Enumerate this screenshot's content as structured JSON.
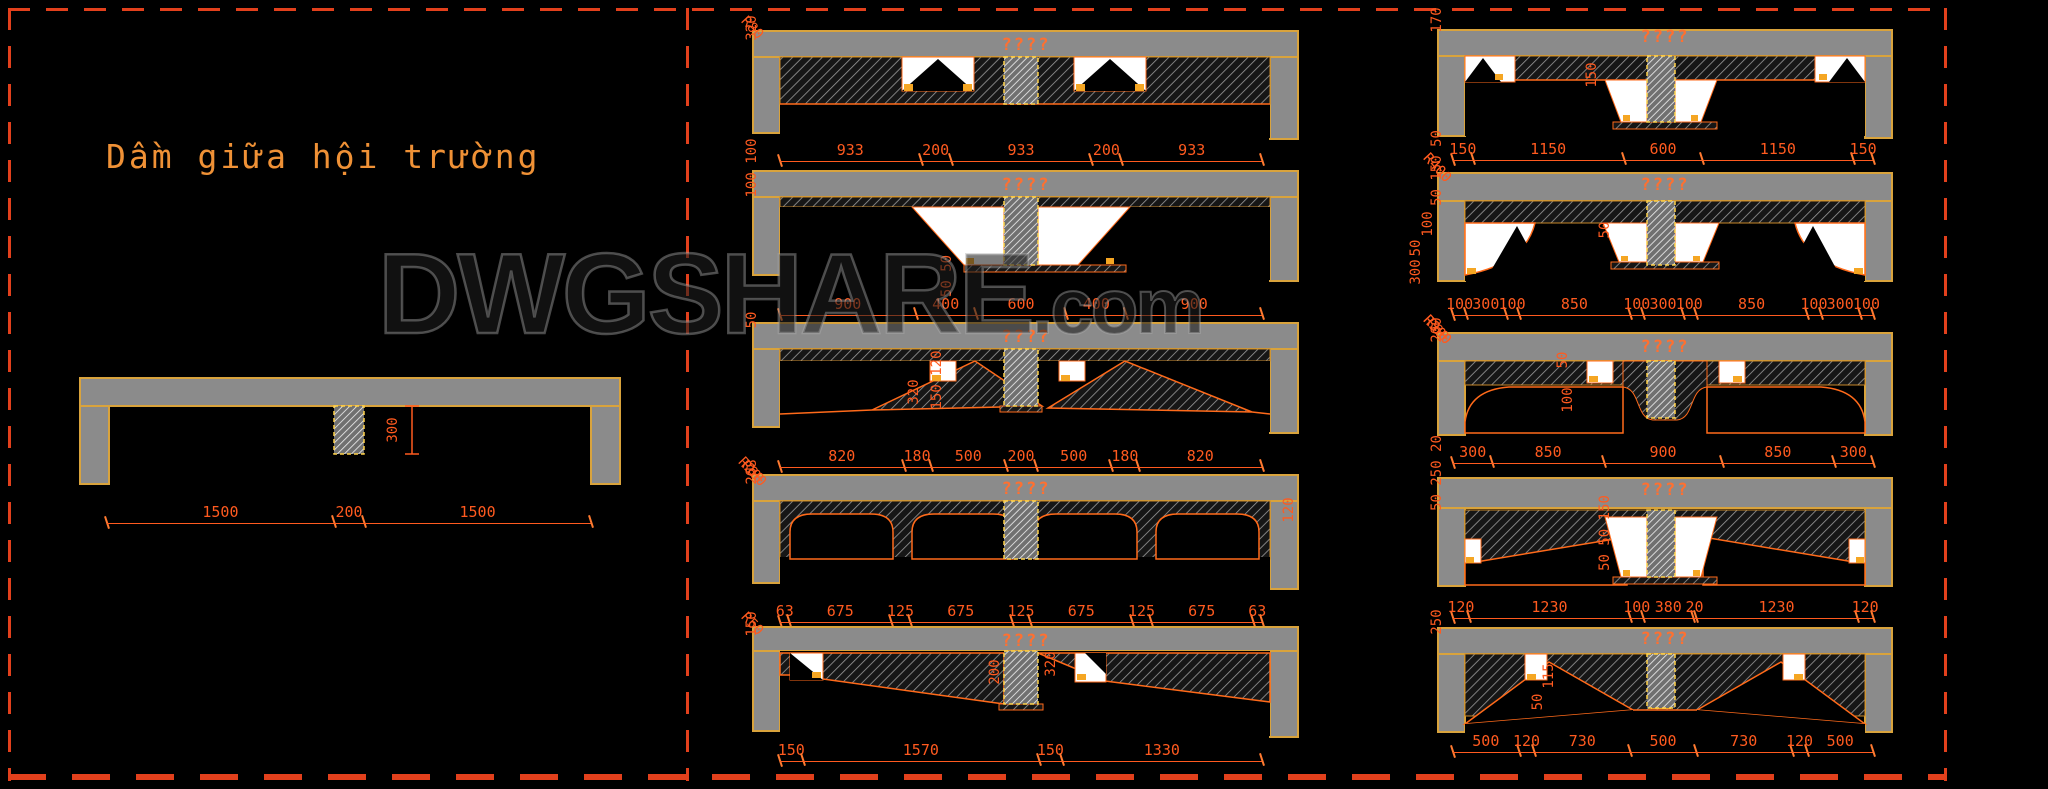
{
  "watermark": {
    "text": "DWGSHARE",
    "suffix": ".com"
  },
  "colors": {
    "background": "#000000",
    "slab_gray": "#8b8b8b",
    "outline_orange": "#d9a33c",
    "dimension_orange": "#ff5a1f",
    "title_orange": "#ef9136",
    "dashed_border_red": "#e2401c"
  },
  "left_panel": {
    "title": "Dầm giữa hội trường",
    "dims": [
      "1500",
      "200",
      "1500"
    ],
    "vlabels": [
      "300"
    ]
  },
  "details": {
    "m1": {
      "caption": "????",
      "dims": [
        "933",
        "200",
        "933",
        "200",
        "933"
      ],
      "vlabels": [
        "320"
      ],
      "rlabels": [
        "R80"
      ]
    },
    "m2": {
      "caption": "????",
      "dims": [
        "900",
        "400",
        "600",
        "400",
        "900"
      ],
      "vlabels": [
        "50 50",
        "100 100"
      ],
      "rlabels": []
    },
    "m3": {
      "caption": "????",
      "dims": [
        "820",
        "180",
        "500",
        "200",
        "500",
        "180",
        "820"
      ],
      "vlabels": [
        "320",
        "150 120",
        "50"
      ],
      "rlabels": []
    },
    "m4": {
      "caption": "????",
      "dims": [
        "63",
        "675",
        "125",
        "675",
        "125",
        "675",
        "125",
        "675",
        "63"
      ],
      "vlabels": [
        "120",
        "268"
      ],
      "rlabels": [
        "R200",
        "R80"
      ]
    },
    "m5": {
      "caption": "????",
      "dims": [
        "150",
        "1570",
        "150",
        "1330"
      ],
      "vlabels": [
        "200",
        "320",
        "150"
      ],
      "rlabels": [
        "R50"
      ]
    },
    "r1": {
      "caption": "????",
      "dims": [
        "150",
        "1150",
        "600",
        "1150",
        "150"
      ],
      "vlabels": [
        "150",
        "170"
      ],
      "rlabels": []
    },
    "r2": {
      "caption": "????",
      "dims": [
        "100",
        "300",
        "100",
        "850",
        "100",
        "300",
        "100",
        "850",
        "100",
        "300",
        "100"
      ],
      "vlabels": [
        "100",
        "50",
        "300",
        "50",
        "50 150 50"
      ],
      "rlabels": [
        "R400",
        "R400"
      ]
    },
    "r3": {
      "caption": "????",
      "dims": [
        "300",
        "850",
        "900",
        "850",
        "300"
      ],
      "vlabels": [
        "50",
        "100",
        "200"
      ],
      "rlabels": [
        "R300",
        "R300",
        "R80"
      ]
    },
    "r4": {
      "caption": "????",
      "dims": [
        "120",
        "1230",
        "100",
        "380",
        "20",
        "1230",
        "120"
      ],
      "vlabels": [
        "50 50 150",
        "50 250 20"
      ],
      "rlabels": []
    },
    "r5": {
      "caption": "????",
      "dims": [
        "500",
        "120",
        "730",
        "500",
        "730",
        "120",
        "500"
      ],
      "vlabels": [
        "115",
        "50",
        "250"
      ],
      "rlabels": []
    }
  }
}
